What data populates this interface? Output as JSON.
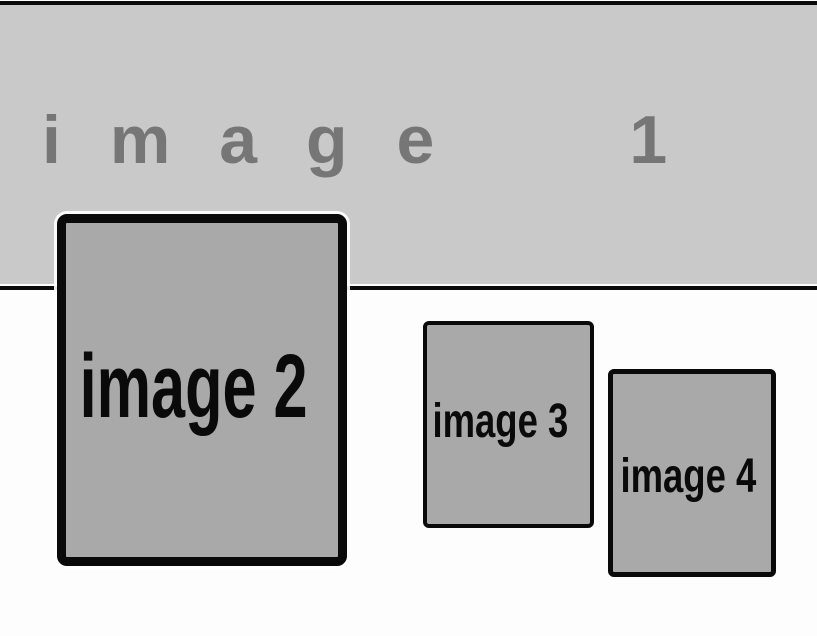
{
  "canvas": {
    "background": "#fdfdfd",
    "outline_color": "#0a0a0a"
  },
  "banner": {
    "label": "image 1",
    "background": "#c9c9c9",
    "text_color": "#767676"
  },
  "placeholders": [
    {
      "name": "image-2",
      "label": "image 2",
      "fill": "#a9a9a9",
      "text_color": "#0a0a0a"
    },
    {
      "name": "image-3",
      "label": "image 3",
      "fill": "#a9a9a9",
      "text_color": "#0a0a0a"
    },
    {
      "name": "image-4",
      "label": "image 4",
      "fill": "#a9a9a9",
      "text_color": "#0a0a0a"
    }
  ]
}
